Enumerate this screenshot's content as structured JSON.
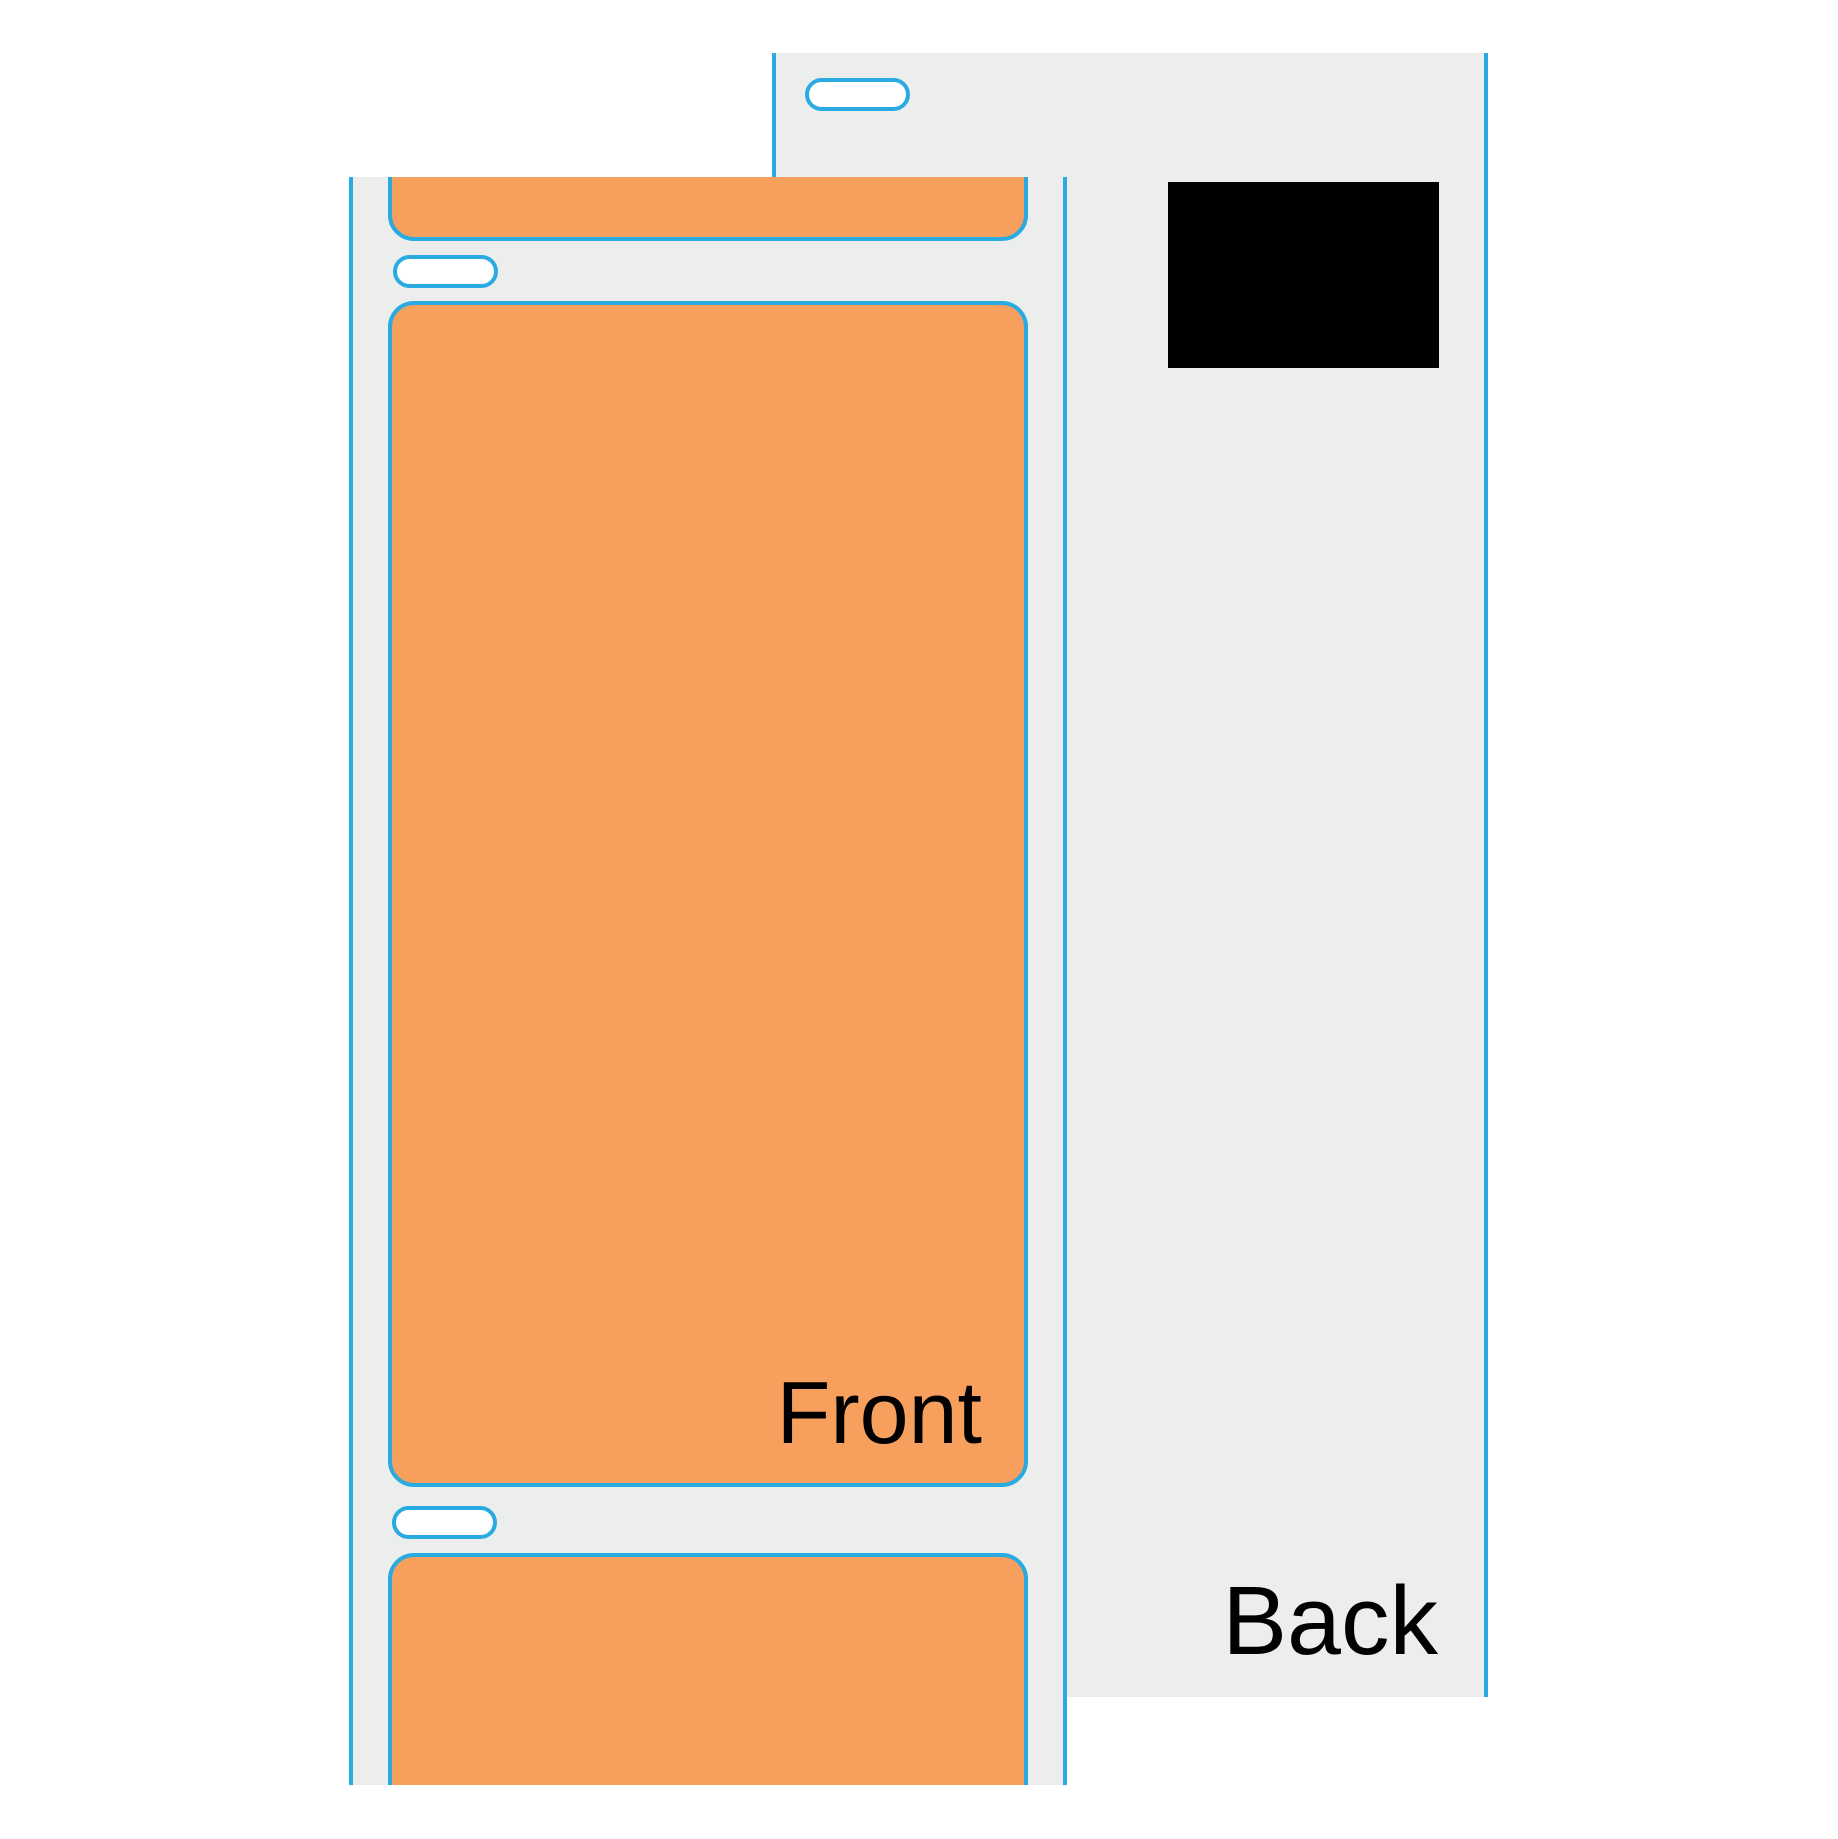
{
  "diagram": {
    "title_visible": false,
    "front_strip": {
      "label": "Front",
      "labels_visible": 3,
      "notches": 2
    },
    "back_strip": {
      "label": "Back",
      "notches": 1,
      "has_black_sensor_mark": true
    }
  },
  "shapes": {
    "liner_notch": "rounded-pill-slot",
    "sensor_mark": "black-rectangle"
  },
  "colors": {
    "label_orange": "#F7A05E",
    "outline_blue": "#29ABE2",
    "liner_gray": "#ECEDED",
    "mark_black": "#000000",
    "text_black": "#000000"
  }
}
